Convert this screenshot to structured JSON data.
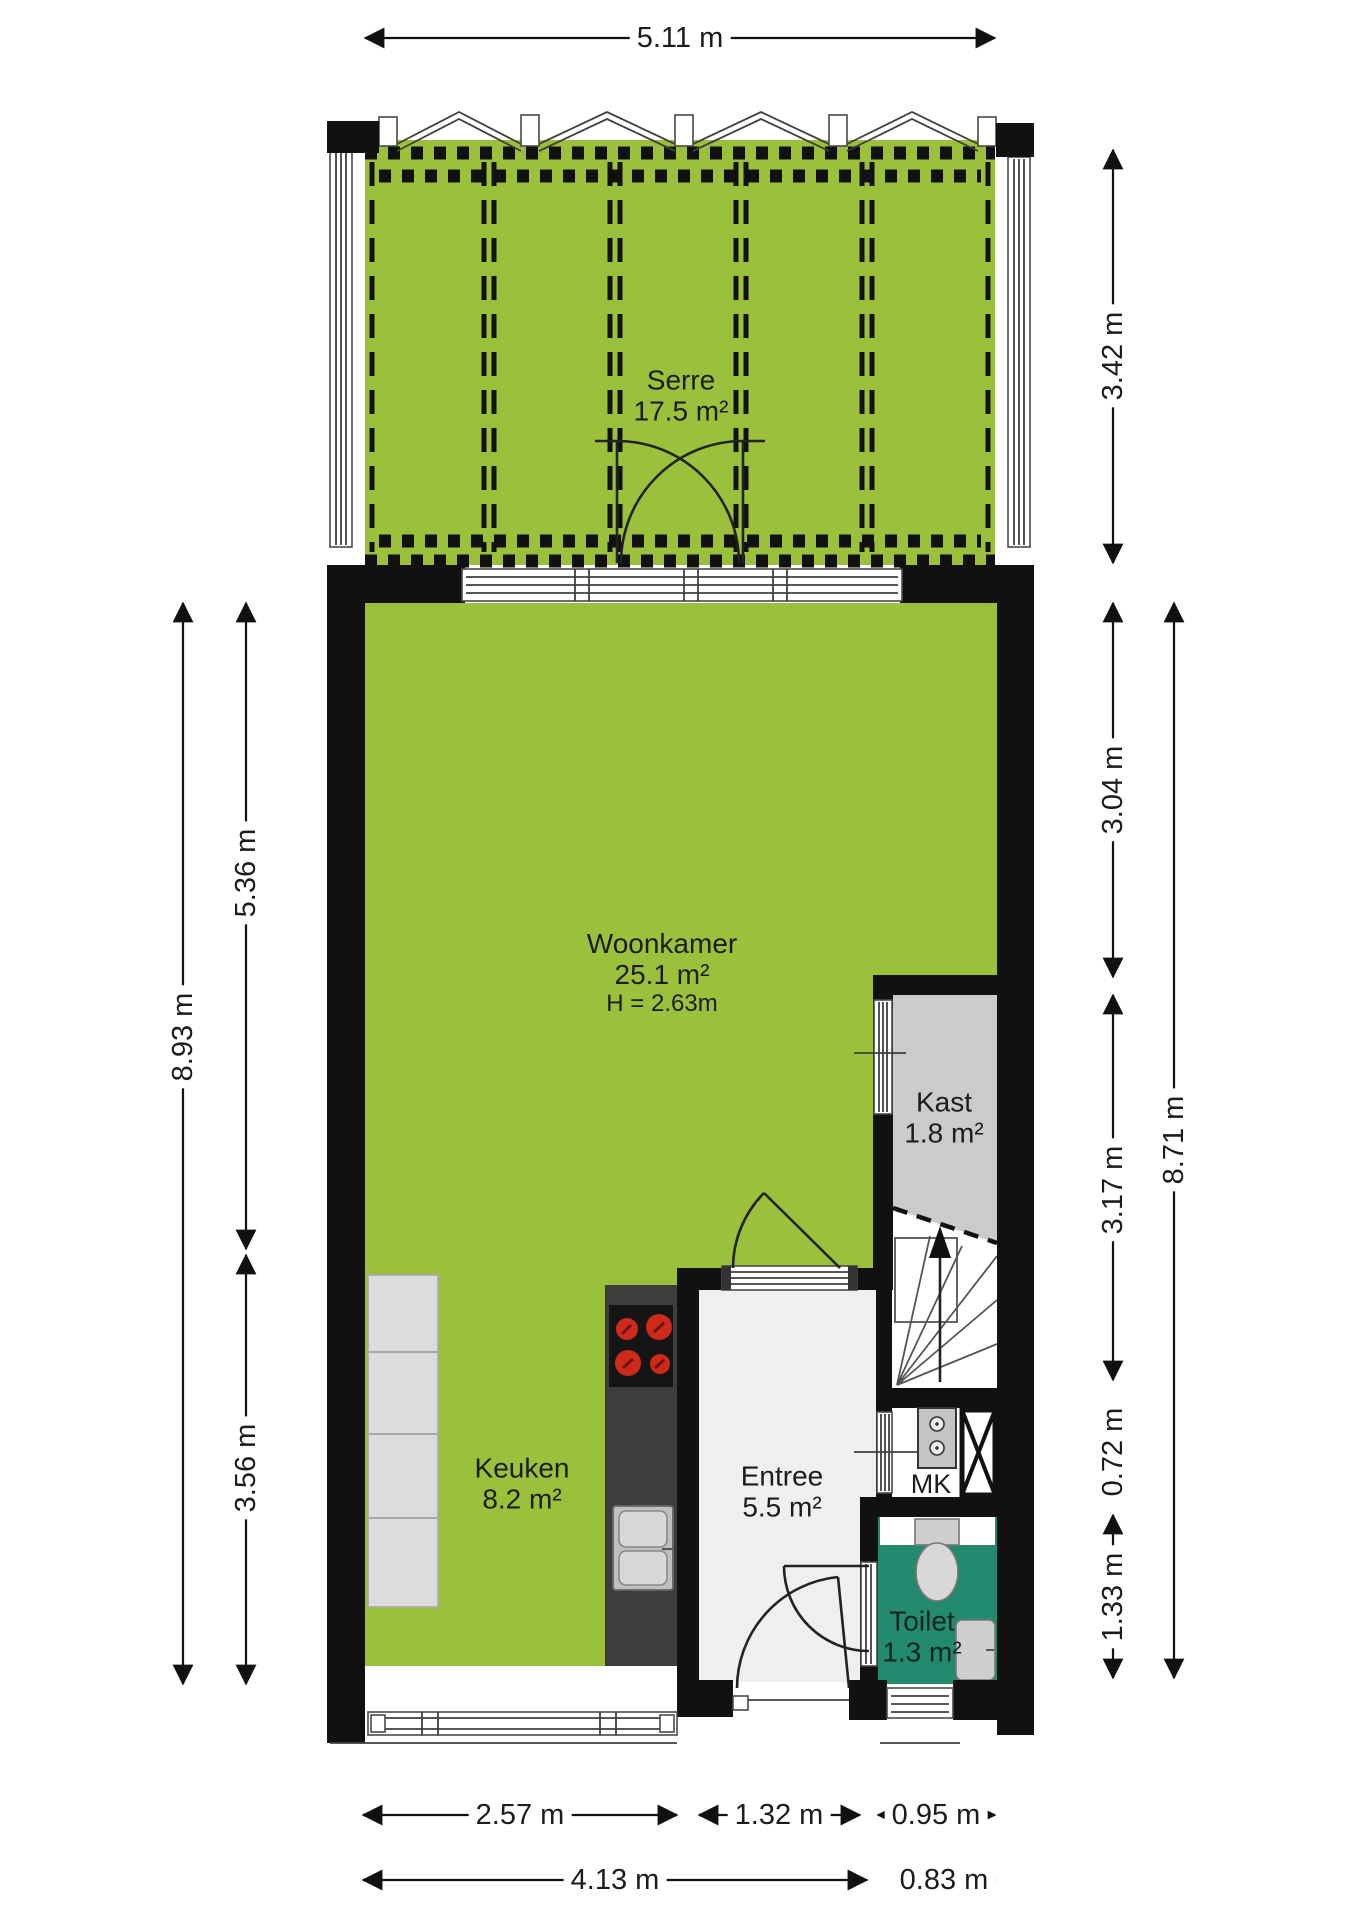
{
  "rooms": {
    "serre": {
      "name": "Serre",
      "area": "17.5 m²"
    },
    "woonkamer": {
      "name": "Woonkamer",
      "area": "25.1 m²",
      "height": "H = 2.63m"
    },
    "kast": {
      "name": "Kast",
      "area": "1.8 m²"
    },
    "keuken": {
      "name": "Keuken",
      "area": "8.2 m²"
    },
    "entree": {
      "name": "Entree",
      "area": "5.5 m²"
    },
    "toilet": {
      "name": "Toilet",
      "area": "1.3 m²"
    },
    "meterkast": {
      "name": "MK"
    }
  },
  "dimensions": {
    "top_width": "5.11 m",
    "serre_depth": "3.42 m",
    "right_upper": "3.04 m",
    "right_mid": "3.17 m",
    "right_mk": "0.72 m",
    "right_toilet": "1.33 m",
    "right_total": "8.71 m",
    "left_total": "8.93 m",
    "left_upper": "5.36 m",
    "left_lower": "3.56 m",
    "bottom_keuken": "2.57 m",
    "bottom_entree": "1.32 m",
    "bottom_toilet": "0.95 m",
    "bottom_main": "4.13 m",
    "bottom_right": "0.83 m"
  },
  "colors": {
    "room_green": "#9BC13C",
    "toilet_teal": "#23896F",
    "wall_black": "#111111",
    "kast_grey": "#CBCBCB",
    "counter_dark": "#3D3D3D",
    "counter_light": "#DCDCDC",
    "burner_red": "#CE2A1C"
  }
}
